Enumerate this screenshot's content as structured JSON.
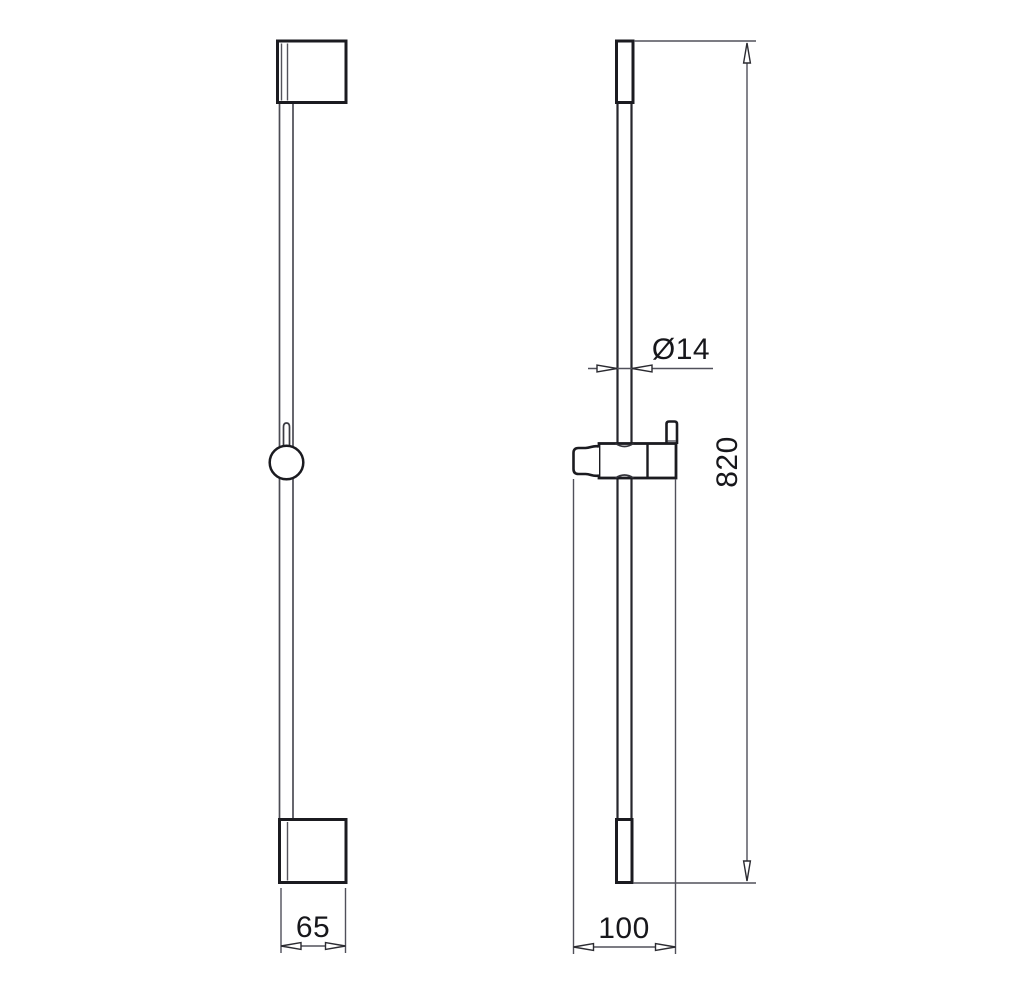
{
  "drawing": {
    "labels": {
      "width": "65",
      "depth": "100",
      "height": "820",
      "diameter": "Ø14"
    },
    "colors": {
      "outline": "#1b1b20",
      "dimension_lines": "#50505a",
      "text": "#17171b",
      "background": "#ffffff"
    }
  }
}
